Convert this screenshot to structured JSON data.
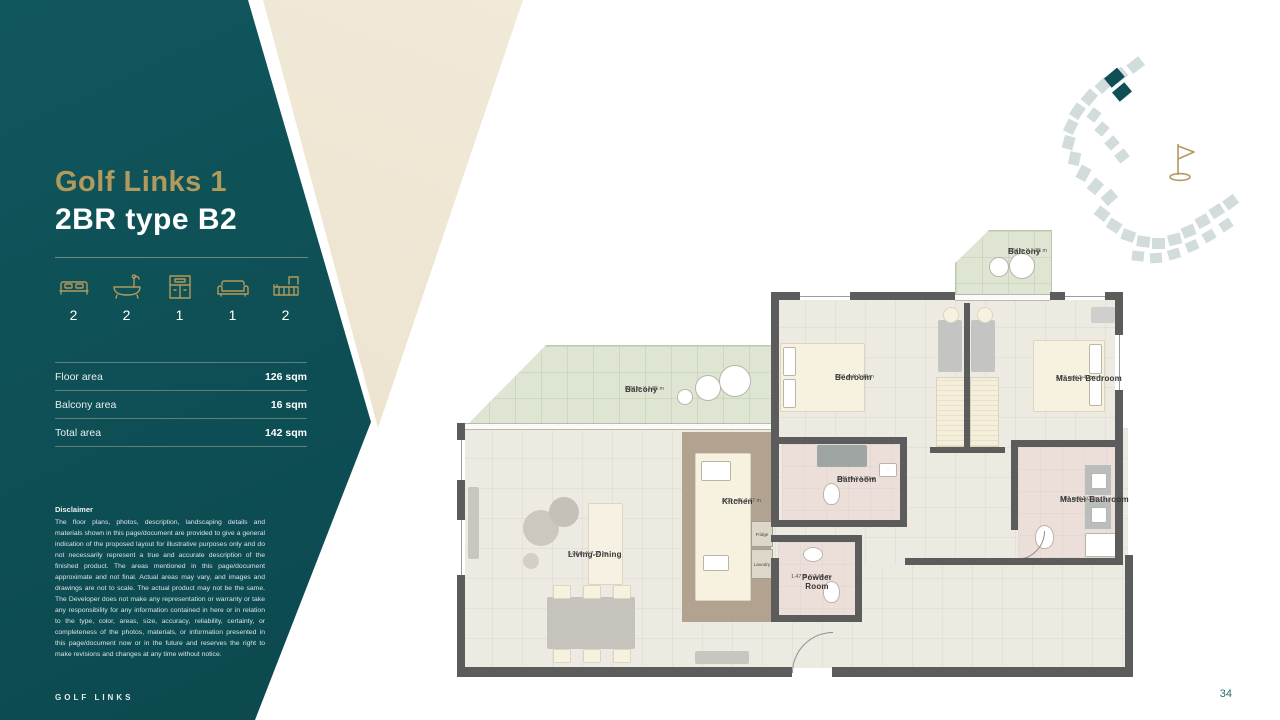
{
  "page": {
    "number": "34",
    "footer_brand": "GOLF LINKS"
  },
  "colors": {
    "teal": "#0d4f55",
    "gold": "#b29a5c",
    "beige": "#f0e9da"
  },
  "sidebar": {
    "title_line1": "Golf Links 1",
    "title_line2": "2BR type B2",
    "features": [
      {
        "icon": "bed-icon",
        "count": "2"
      },
      {
        "icon": "bath-icon",
        "count": "2"
      },
      {
        "icon": "kitchen-icon",
        "count": "1"
      },
      {
        "icon": "sofa-icon",
        "count": "1"
      },
      {
        "icon": "balcony-icon",
        "count": "2"
      }
    ],
    "areas": [
      {
        "label": "Floor area",
        "value": "126 sqm"
      },
      {
        "label": "Balcony area",
        "value": "16 sqm"
      },
      {
        "label": "Total area",
        "value": "142 sqm"
      }
    ],
    "disclaimer_title": "Disclaimer",
    "disclaimer_body": "The floor plans, photos, description, landscaping details and materials shown in this page/document are provided to give a general indication of the proposed layout for illustrative purposes only and do not necessarily represent a true and accurate description of the finished product. The areas mentioned in this page/document approximate and not final. Actual areas may vary, and images and drawings are not to scale. The actual product may not be the same. The Developer does not make any representation or warranty or take any responsibility for any information contained in here or in relation to the type, color, areas, size, accuracy, reliability, certainty, or completeness of the photos, materials, or information presented in this page/document now or in the future and reserves the right to make revisions and changes at any time without notice."
  },
  "floorplan": {
    "rooms": [
      {
        "name": "Balcony",
        "dims": "3.54 m X 1.85 m"
      },
      {
        "name": "Balcony",
        "dims": "8.28 m X 1.85 m"
      },
      {
        "name": "Living-Dining",
        "dims": "5.00 m X 7.35 m"
      },
      {
        "name": "Kitchen",
        "dims": "3.00 m X 3.77 m"
      },
      {
        "name": "Bathroom",
        "dims": "2.45 m X 1.80 m"
      },
      {
        "name": "Powder Room",
        "dims": "1.47 m X 2.16 m"
      },
      {
        "name": "Bedroom",
        "dims": "4.15 m X 3.40 m"
      },
      {
        "name": "Master Bedroom",
        "dims": "4.27 m X 3.40 m"
      },
      {
        "name": "Master Bathroom",
        "dims": "1.82 m X 3.04 m"
      }
    ],
    "appliances": [
      {
        "label": "Fridge"
      },
      {
        "label": "Laundry"
      }
    ]
  }
}
